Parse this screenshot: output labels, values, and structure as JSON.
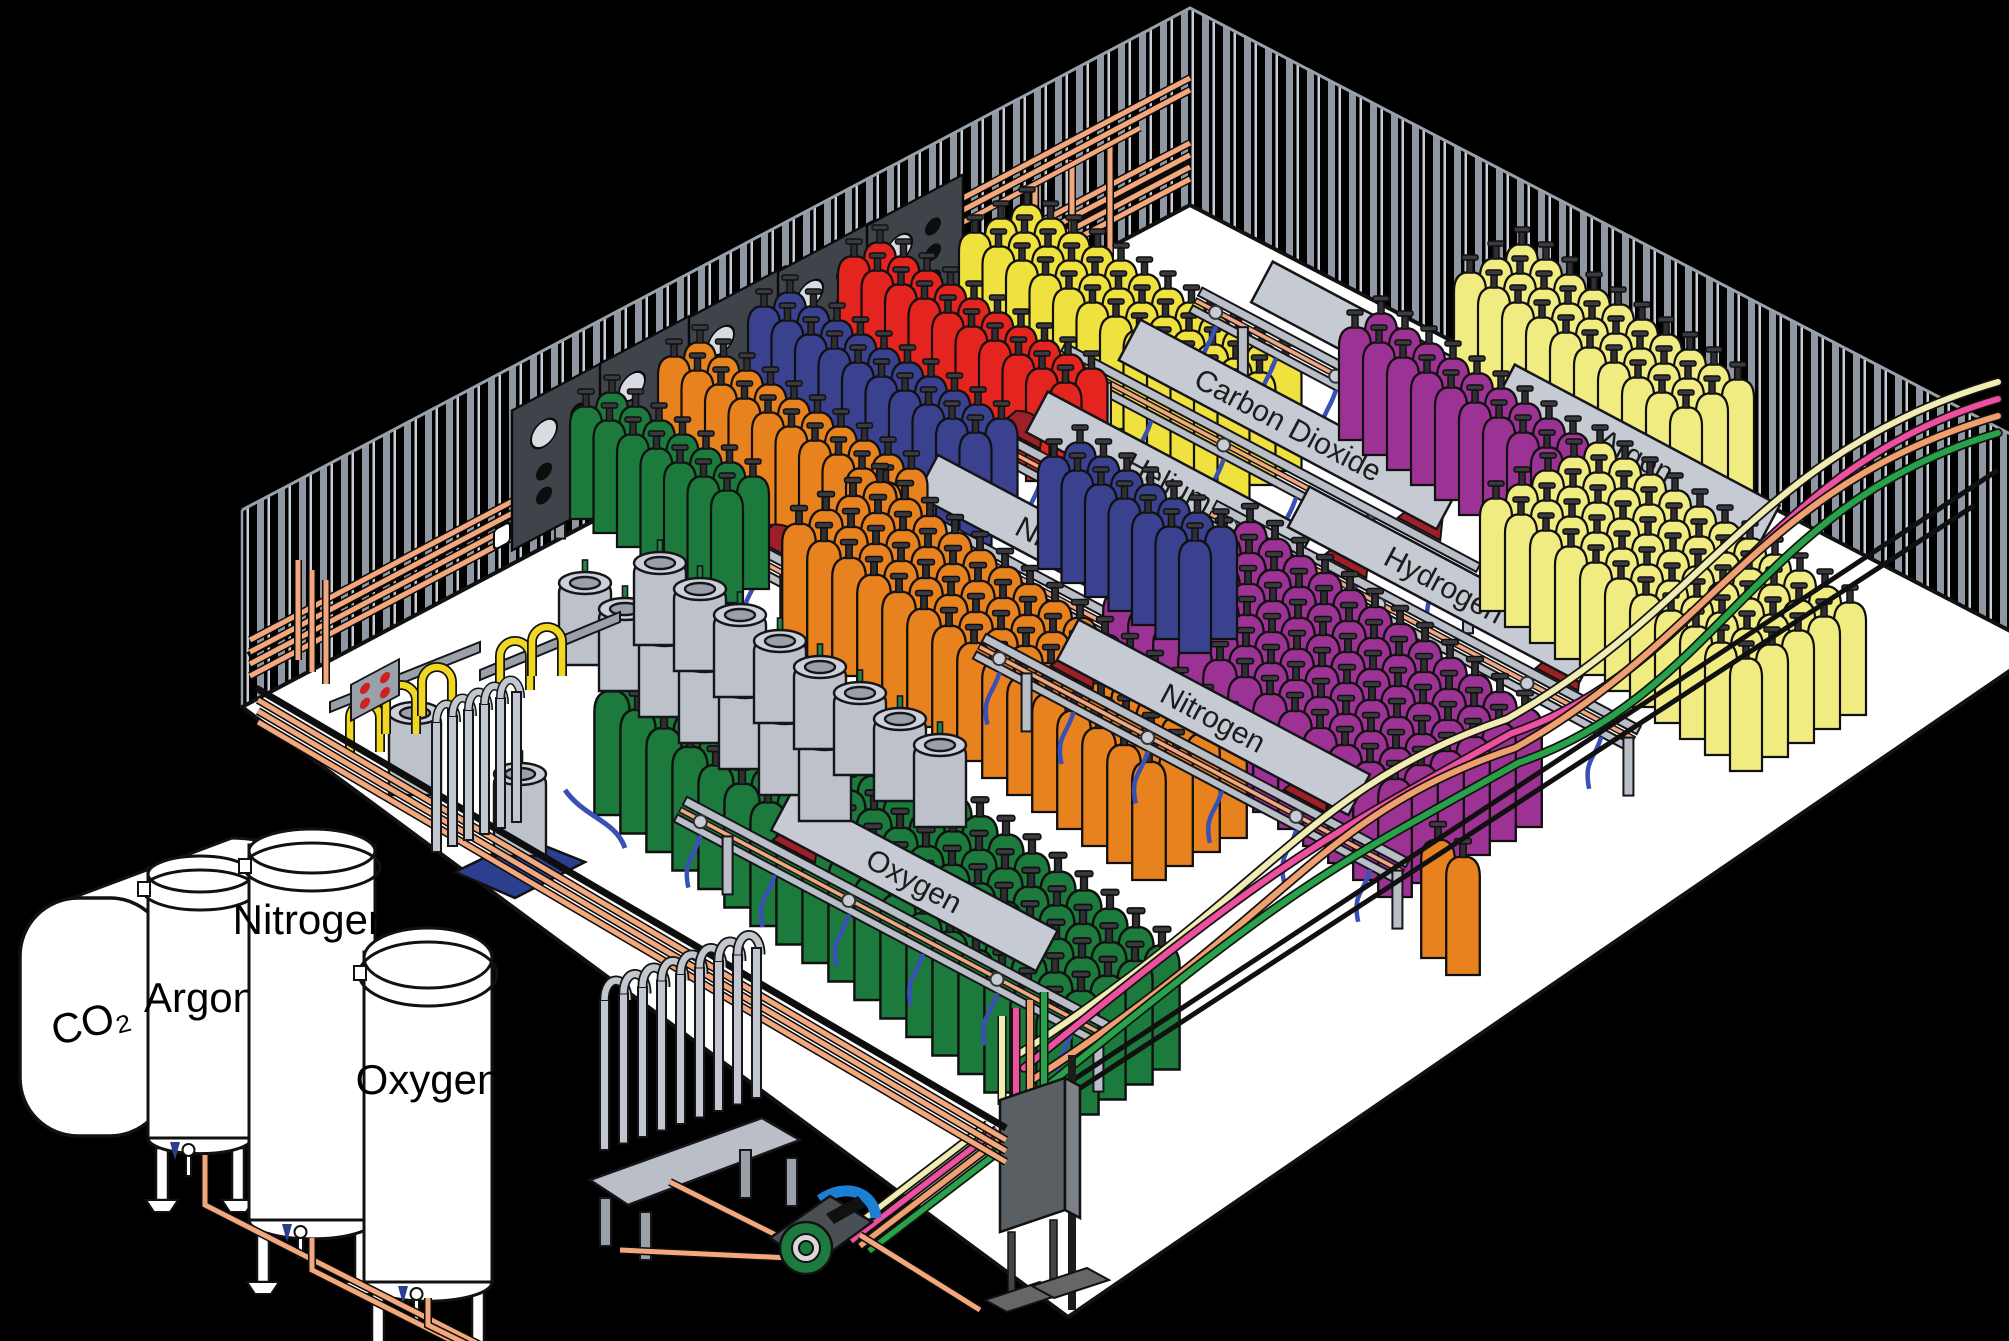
{
  "title": "Industrial gas cylinder filling plant (isometric cutaway)",
  "colors": {
    "background": "#000000",
    "floor": "#ffffff",
    "wall_stripe": "#8f97a2",
    "wall_stripe_light": "#c9ced6",
    "copper_pipe": "#f2a87c",
    "rail_gray": "#b9bec7",
    "banner_gray": "#c6cad2",
    "hose_blue": "#3a50b4",
    "torpedo_maroon": "#9c2025",
    "pigtail_yellow": "#f2d722",
    "pallet_blue": "#2c3f8e",
    "pump_green": "#1d7a3e",
    "pump_blue": "#1b7fd4",
    "panel_dark": "#3f444b",
    "outline": "#111111"
  },
  "tanks": [
    {
      "id": "co2",
      "label": "CO₂"
    },
    {
      "id": "argon",
      "label": "Argon"
    },
    {
      "id": "nitrogen",
      "label": "Nitrogen"
    },
    {
      "id": "oxygen",
      "label": "Oxygen"
    }
  ],
  "stations": [
    {
      "label": "Oxygen",
      "x": 953,
      "y": 613,
      "len": 440,
      "blen": 300,
      "z": 90,
      "torpedoes": [
        -0.42
      ]
    },
    {
      "label": "Nitrogen",
      "x": 1067,
      "y": 553,
      "len": 440,
      "blen": 320,
      "z": 70,
      "torpedoes": [
        -0.38
      ]
    },
    {
      "label": "Helium",
      "x": 1168,
      "y": 485,
      "len": 440,
      "blen": 300,
      "z": 50,
      "torpedoes": [
        -0.35
      ]
    },
    {
      "label": "Carbon Dioxide",
      "x": 1287,
      "y": 427,
      "len": 470,
      "blen": 360,
      "z": 30,
      "torpedoes": [
        0.35
      ]
    },
    {
      "label": "Argon",
      "x": 1393,
      "y": 355,
      "len": 400,
      "blen": 300,
      "z": 20,
      "torpedoes": []
    },
    {
      "label": "Hydrogen",
      "x": 1443,
      "y": 587,
      "len": 480,
      "blen": 330,
      "z": 140,
      "torpedoes": [
        -0.2,
        0.3
      ]
    },
    {
      "label": "Argon",
      "x": 1635,
      "y": 458,
      "len": 470,
      "blen": 300,
      "z": 120,
      "torpedoes": [
        0.28
      ]
    },
    {
      "label": "Nitrogen",
      "x": 1212,
      "y": 720,
      "len": 480,
      "blen": 330,
      "z": 190,
      "torpedoes": [
        -0.3,
        0.25
      ]
    },
    {
      "label": "Oxygen",
      "x": 913,
      "y": 883,
      "len": 480,
      "blen": 300,
      "z": 210,
      "torpedoes": [
        -0.25
      ]
    }
  ],
  "cylinder_groups": [
    {
      "name": "carbon-dioxide-cylinders",
      "gas": "Carbon Dioxide",
      "color": "#efe23e",
      "x": 975,
      "y": 345,
      "cols": 12,
      "rows": 3,
      "cs": [
        23.5,
        14
      ],
      "rs": [
        26,
        -14
      ],
      "scale": 1.0,
      "z": 10
    },
    {
      "name": "helium-cylinders",
      "gas": "Helium",
      "color": "#e3241f",
      "x": 854,
      "y": 369,
      "cols": 10,
      "rows": 2,
      "cs": [
        23.5,
        14
      ],
      "rs": [
        26,
        -14
      ],
      "scale": 1.0,
      "z": 40
    },
    {
      "name": "nitrogen-cylinders-back",
      "gas": "Nitrogen",
      "color": "#3a418f",
      "x": 764,
      "y": 419,
      "cols": 10,
      "rows": 2,
      "cs": [
        23.5,
        14
      ],
      "rs": [
        26,
        -14
      ],
      "scale": 1.0,
      "z": 60
    },
    {
      "name": "orange-cylinders-back",
      "gas": "Nitrogen",
      "color": "#e8821e",
      "x": 674,
      "y": 469,
      "cols": 10,
      "rows": 2,
      "cs": [
        23.5,
        14
      ],
      "rs": [
        26,
        -14
      ],
      "scale": 1.0,
      "z": 80
    },
    {
      "name": "oxygen-cylinders-back",
      "gas": "Oxygen",
      "color": "#1b7a3c",
      "x": 586,
      "y": 519,
      "cols": 7,
      "rows": 2,
      "cs": [
        23.5,
        14
      ],
      "rs": [
        26,
        -14
      ],
      "scale": 1.0,
      "z": 100
    },
    {
      "name": "argon-cylinders-right",
      "gas": "Argon",
      "color": "#f1ec82",
      "x": 1470,
      "y": 385,
      "cols": 10,
      "rows": 3,
      "cs": [
        24,
        15
      ],
      "rs": [
        26,
        -14
      ],
      "scale": 1.0,
      "z": 110
    },
    {
      "name": "hydrogen-cylinders-band",
      "gas": "Hydrogen",
      "color": "#9c3293",
      "x": 1355,
      "y": 440,
      "cols": 9,
      "rows": 2,
      "cs": [
        24,
        15
      ],
      "rs": [
        26,
        -14
      ],
      "scale": 1.0,
      "z": 130
    },
    {
      "name": "pale-yellow-block-front",
      "gas": "Argon",
      "color": "#f1ec82",
      "x": 1496,
      "y": 611,
      "cols": 11,
      "rows": 5,
      "cs": [
        25,
        16
      ],
      "rs": [
        26,
        -14
      ],
      "scale": 1.0,
      "z": 150
    },
    {
      "name": "hydrogen-block-front",
      "gas": "Hydrogen",
      "color": "#9c3293",
      "x": 1120,
      "y": 710,
      "cols": 12,
      "rows": 6,
      "cs": [
        25,
        17
      ],
      "rs": [
        26,
        -14
      ],
      "scale": 1.05,
      "z": 160
    },
    {
      "name": "nitrogen-cylinders-mid",
      "gas": "Nitrogen",
      "color": "#3a418f",
      "x": 1054,
      "y": 569,
      "cols": 7,
      "rows": 2,
      "cs": [
        23.5,
        14
      ],
      "rs": [
        26,
        -14
      ],
      "scale": 1.0,
      "z": 170
    },
    {
      "name": "orange-block-front",
      "gas": "Nitrogen",
      "color": "#e8821e",
      "x": 799,
      "y": 642,
      "cols": 15,
      "rows": 4,
      "cs": [
        25,
        17
      ],
      "rs": [
        27,
        -14
      ],
      "scale": 1.05,
      "z": 180
    },
    {
      "name": "oxygen-block-front",
      "gas": "Oxygen",
      "color": "#1b7a3c",
      "x": 612,
      "y": 815,
      "cols": 18,
      "rows": 5,
      "cs": [
        26,
        18.5
      ],
      "rs": [
        27,
        -15
      ],
      "scale": 1.1,
      "z": 200
    },
    {
      "name": "orange-pair-front",
      "gas": "Nitrogen",
      "color": "#e8821e",
      "x": 1438,
      "y": 958,
      "cols": 2,
      "rows": 1,
      "cs": [
        25,
        17
      ],
      "rs": [
        27,
        -14
      ],
      "scale": 1.05,
      "z": 205
    }
  ],
  "supply_lines": [
    {
      "name": "supply-line-cream",
      "color": "#f1ecb4"
    },
    {
      "name": "supply-line-pink",
      "color": "#ee4fa0"
    },
    {
      "name": "supply-line-salmon",
      "color": "#f0a070"
    },
    {
      "name": "supply-line-green",
      "color": "#27a24a"
    }
  ],
  "wall_panels": [
    {
      "x": 560,
      "y": 455
    },
    {
      "x": 648,
      "y": 408
    },
    {
      "x": 737,
      "y": 362
    },
    {
      "x": 826,
      "y": 316
    },
    {
      "x": 915,
      "y": 270
    }
  ],
  "dewar_lines": [
    {
      "x": 585,
      "y": 665,
      "n": 7,
      "step": [
        40,
        26
      ]
    },
    {
      "x": 660,
      "y": 645,
      "n": 8,
      "step": [
        40,
        26
      ]
    }
  ],
  "dewar_singles": [
    {
      "x": 415,
      "y": 795
    },
    {
      "x": 520,
      "y": 856
    }
  ]
}
